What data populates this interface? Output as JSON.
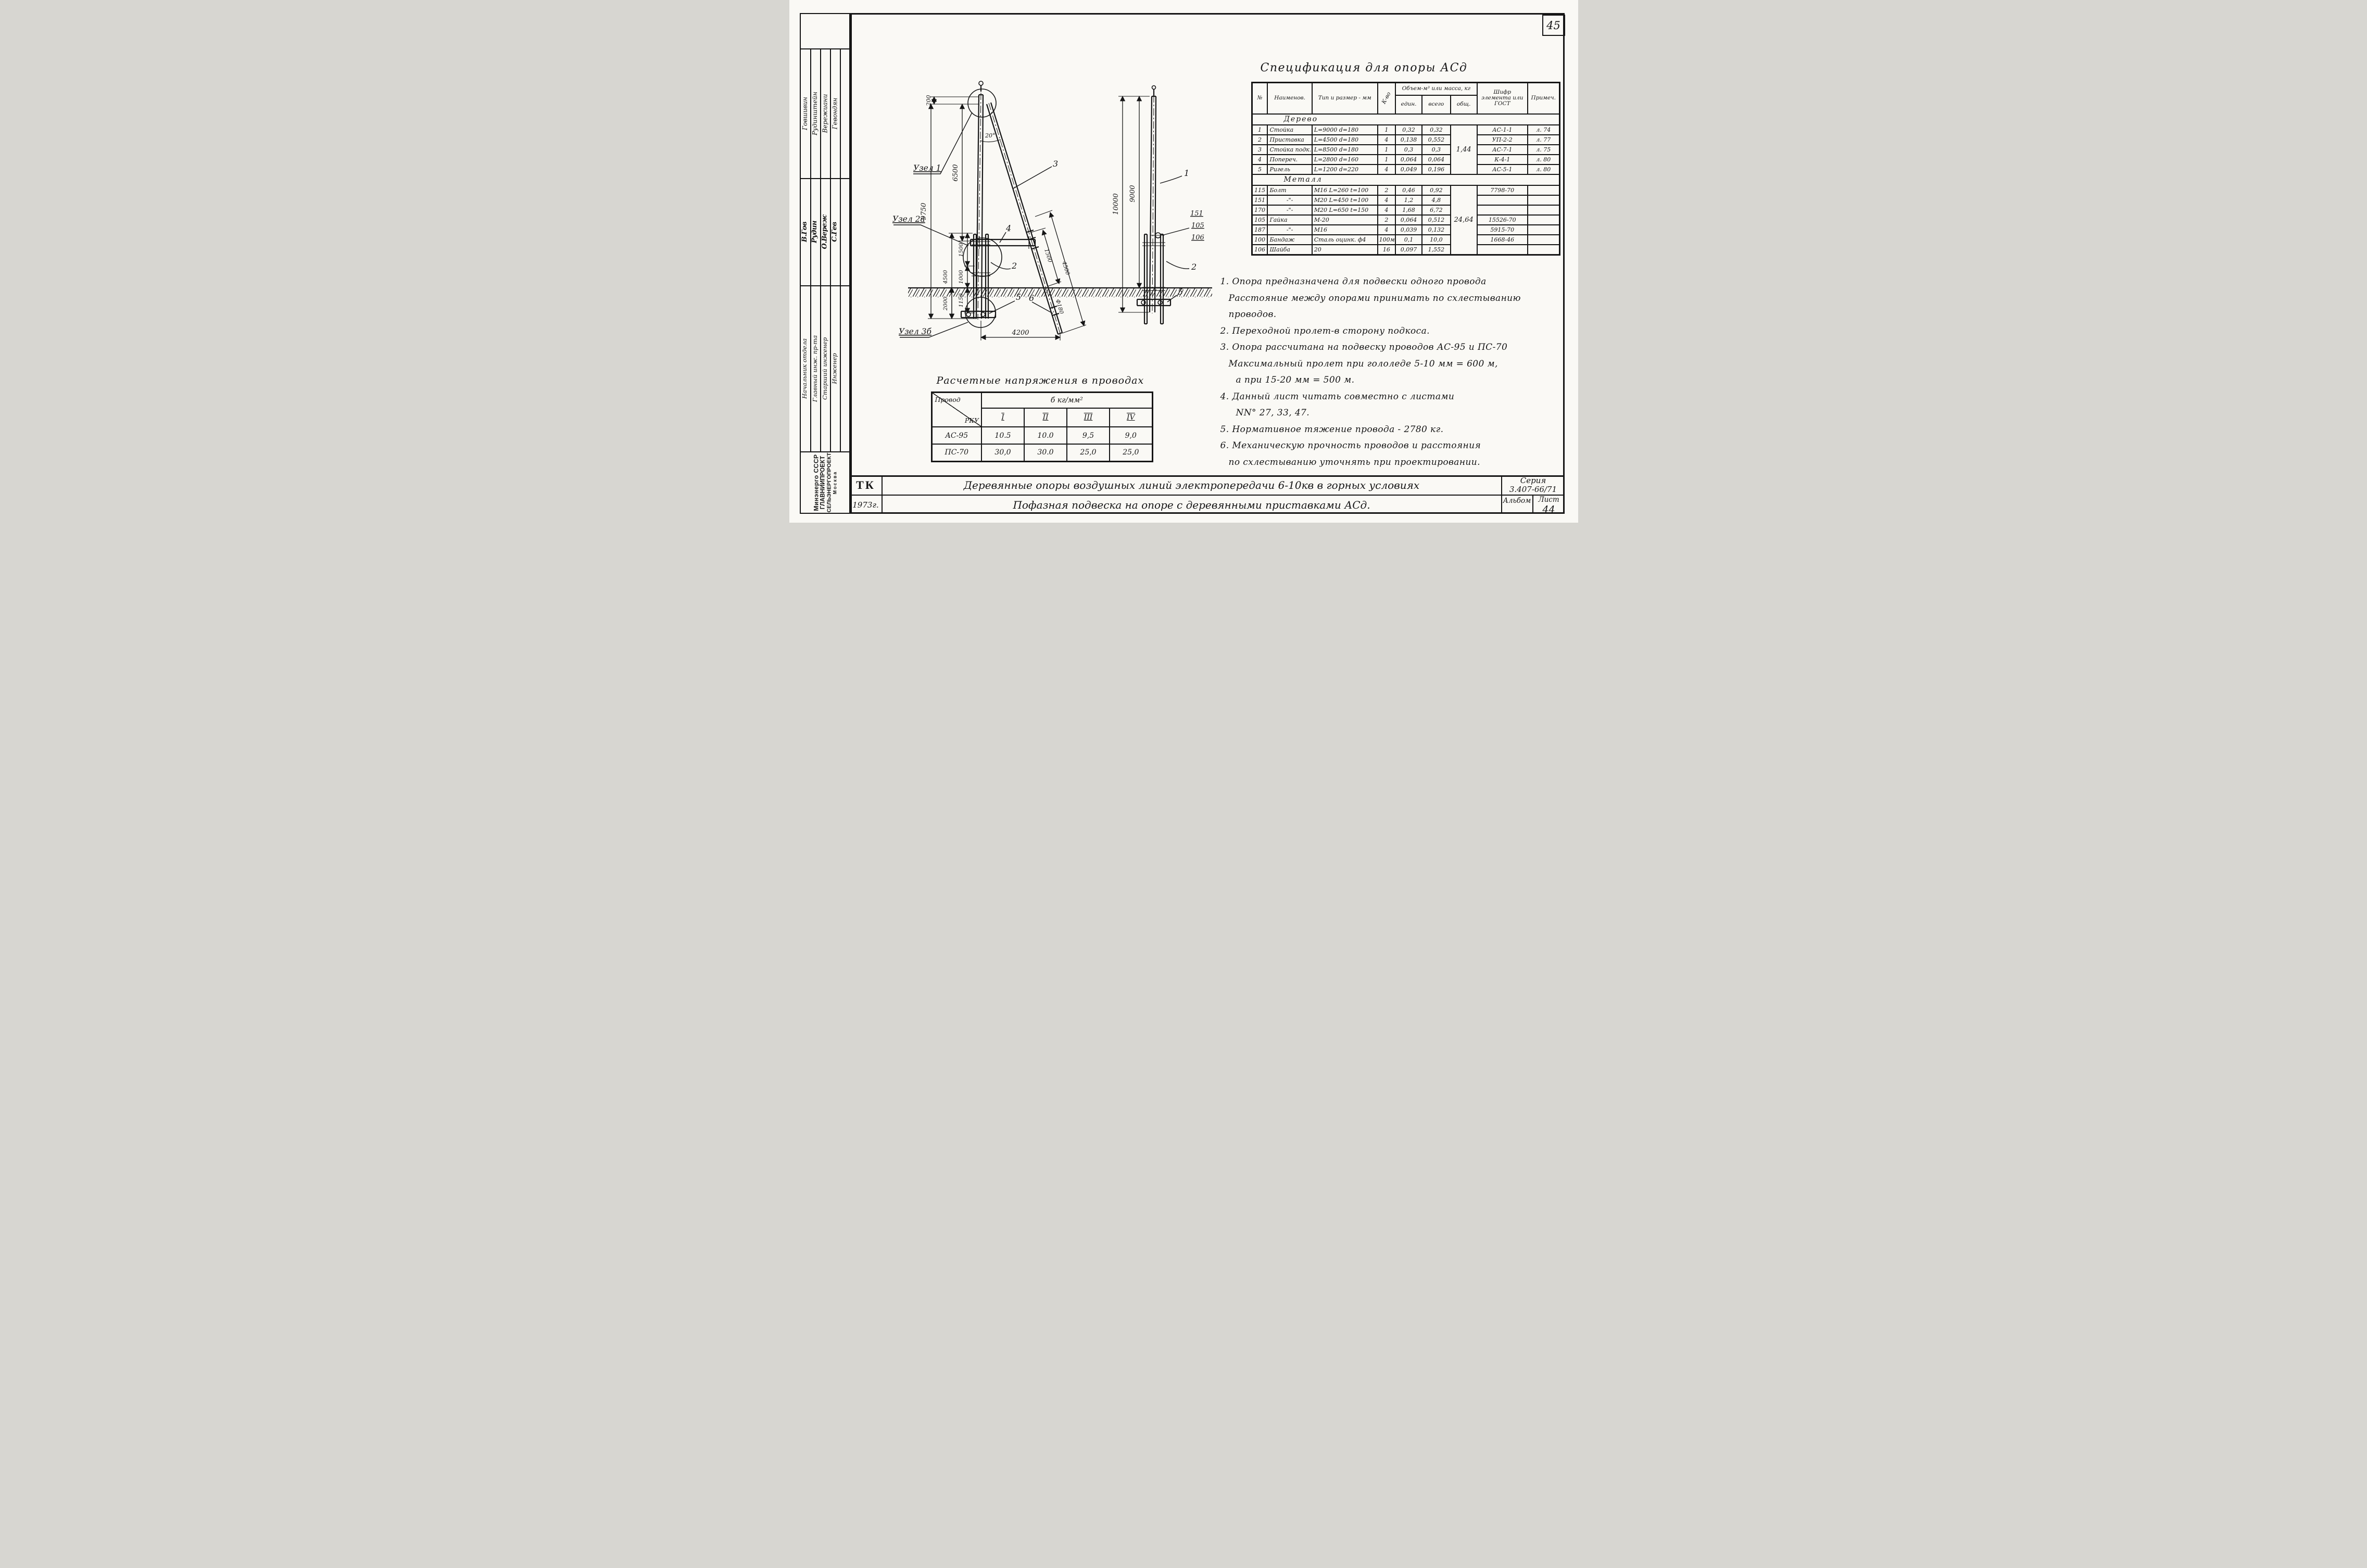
{
  "page": {
    "number": "45"
  },
  "sidebar": {
    "entries": [
      {
        "name": "Говшивин",
        "signature": "В.Гов",
        "role": "Начальник отдела"
      },
      {
        "name": "Рудинштейн",
        "signature": "Рудин",
        "role": "Главный инж. пр-та"
      },
      {
        "name": "Вережиани",
        "signature": "О.Вереж",
        "role": "Старший инженер"
      },
      {
        "name": "Гевондян",
        "signature": "С.Гев",
        "role": "Инженер"
      }
    ],
    "org_lines": [
      "Минэнерго СССР",
      "ГЛАВНИИПРОЕКТ",
      "СЕЛЬЭНЕРГОПРОЕКТ",
      "Москва"
    ]
  },
  "spec": {
    "title": "Спецификация для опоры АСд",
    "col_num": "№",
    "col_name": "Наименов.",
    "col_type": "Тип и размер - мм",
    "col_qty": "К-во",
    "col_volume": "Объем-м³ или масса, кг",
    "col_unit": "един.",
    "col_total": "всего",
    "col_common": "общ.",
    "col_code": "Шифр элемента или ГОСТ",
    "col_note": "Примеч.",
    "section_wood": "Дерево",
    "wood_rows": [
      [
        "1",
        "Стойка",
        "L=9000 d=180",
        "1",
        "0,32",
        "0,32",
        "АС-1-1",
        "л. 74"
      ],
      [
        "2",
        "Приставка",
        "L=4500 d=180",
        "4",
        "0,138",
        "0,552",
        "УП-2-2",
        "л. 77"
      ],
      [
        "3",
        "Стойка подк.",
        "L=8500 d=180",
        "1",
        "0,3",
        "0,3",
        "АС-7-1",
        "л. 75"
      ],
      [
        "4",
        "Попереч.",
        "L=2800 d=160",
        "1",
        "0,064",
        "0,064",
        "К-4-1",
        "л. 80"
      ],
      [
        "5",
        "Ригель",
        "L=1200 d=220",
        "4",
        "0,049",
        "0,196",
        "АС-5-1",
        "л. 80"
      ]
    ],
    "wood_total": "1,44",
    "section_metal": "Металл",
    "metal_rows": [
      [
        "115",
        "Болт",
        "М16 L=260 t=100",
        "2",
        "0,46",
        "0,92",
        "7798-70",
        ""
      ],
      [
        "151",
        "-\"-",
        "М20 L=450 t=100",
        "4",
        "1,2",
        "4,8",
        "",
        ""
      ],
      [
        "170",
        "-\"-",
        "М20 L=650 t=150",
        "4",
        "1,68",
        "6,72",
        "",
        ""
      ],
      [
        "105",
        "Гайка",
        "М-20",
        "2",
        "0,064",
        "0,512",
        "15526-70",
        ""
      ],
      [
        "187",
        "-\"-",
        "М16",
        "4",
        "0,039",
        "0,132",
        "5915-70",
        ""
      ],
      [
        "100",
        "Бандаж",
        "Сталь оцинк. ф4",
        "100м",
        "0,1",
        "10,0",
        "1668-46",
        ""
      ],
      [
        "106",
        "Шайба",
        "20",
        "16",
        "0,097",
        "1,552",
        "",
        ""
      ]
    ],
    "metal_total": "24,64"
  },
  "notes": [
    {
      "lines": [
        "1. Опора предназначена для подвески одного провода",
        "Расстояние между опорами принимать по схлестыванию",
        "проводов."
      ]
    },
    {
      "lines": [
        "2. Переходной пролет-в сторону подкоса."
      ]
    },
    {
      "lines": [
        "3. Опора рассчитана на подвеску проводов АС-95 и ПС-70",
        "Максимальный пролет при гололеде 5-10 мм = 600 м,",
        "а при 15-20 мм = 500 м."
      ]
    },
    {
      "lines": [
        "4. Данный лист читать совместно с листами",
        "NN° 27, 33, 47."
      ]
    },
    {
      "lines": [
        "5. Нормативное тяжение провода - 2780 кг."
      ]
    },
    {
      "lines": [
        "6. Механическую прочность проводов и расстояния",
        "по схлестыванию уточнять при проектировании."
      ]
    }
  ],
  "stress": {
    "title": "Расчетные напряжения в проводах",
    "corner_top": "Провод",
    "corner_bottom": "РКУ",
    "span_header": "б кг/мм²",
    "cols": [
      "I",
      "II",
      "III",
      "IV"
    ],
    "rows": [
      {
        "label": "АС-95",
        "values": [
          "10.5",
          "10.0",
          "9,5",
          "9,0"
        ]
      },
      {
        "label": "ПС-70",
        "values": [
          "30,0",
          "30.0",
          "25,0",
          "25,0"
        ]
      }
    ]
  },
  "tb": {
    "tk": "ТК",
    "year": "1973г.",
    "line1": "Деревянные опоры воздушных линий электропередачи 6-10кв в горных условиях",
    "line2": "Пофазная подвеска на опоре с деревянными приставками АСд.",
    "series_label": "Серия",
    "series_value": "3.407-66/71",
    "album_label": "Альбом",
    "sheet_label": "Лист",
    "sheet_value": "44"
  },
  "fv": {
    "uzel1": "Узел 1",
    "uzel2": "Узел 2а",
    "uzel3": "Узел 3б",
    "d200": "200",
    "d9750": "9750",
    "d6500": "6500",
    "d4500": "4500",
    "d1500": "1500",
    "d1000": "1000",
    "d1150": "1150",
    "d2000": "2000",
    "d4200": "4200",
    "a20": "20°",
    "s1500": "1500",
    "s4500": "4500",
    "f180": "Ф180",
    "c2": "2",
    "c3": "3",
    "c4": "4",
    "c5": "5",
    "c6": "6"
  },
  "sv": {
    "d10000": "10000",
    "d9000": "9000",
    "c1": "1",
    "c151": "151",
    "c105": "105",
    "c106": "106",
    "c2": "2",
    "c5": "5"
  }
}
